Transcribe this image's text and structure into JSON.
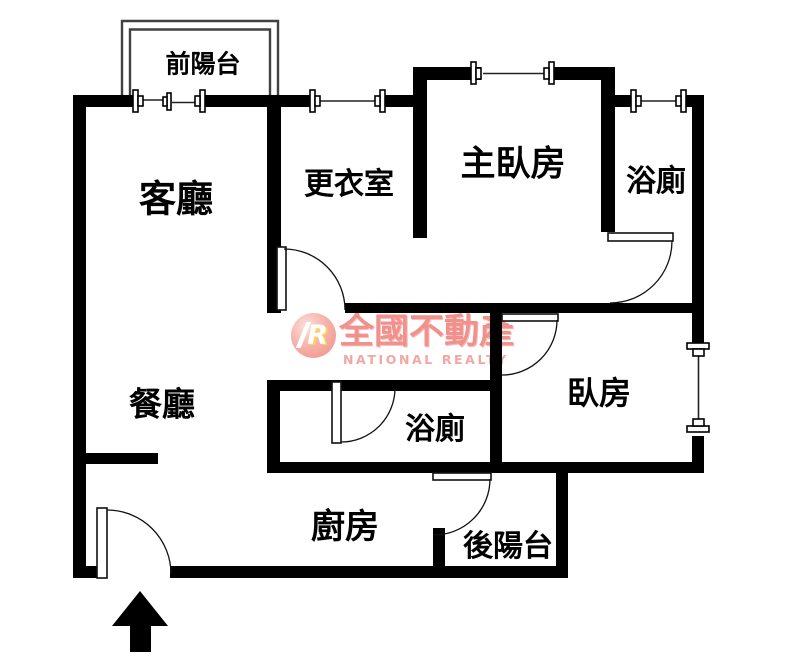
{
  "floorplan": {
    "rooms": [
      {
        "id": "front-balcony",
        "label": "前陽台"
      },
      {
        "id": "living-room",
        "label": "客廳"
      },
      {
        "id": "walk-in-closet",
        "label": "更衣室"
      },
      {
        "id": "master-bedroom",
        "label": "主臥房"
      },
      {
        "id": "bathroom-top",
        "label": "浴廁"
      },
      {
        "id": "dining-room",
        "label": "餐廳"
      },
      {
        "id": "bathroom-middle",
        "label": "浴廁"
      },
      {
        "id": "bedroom",
        "label": "臥房"
      },
      {
        "id": "kitchen",
        "label": "廚房"
      },
      {
        "id": "rear-balcony",
        "label": "後陽台"
      }
    ],
    "watermark": {
      "logo_letter": "R",
      "brand_cn": "全國不動產",
      "brand_en": "NATIONAL REALTY",
      "brand_color": "#f0918d"
    },
    "colors": {
      "wall": "#000000",
      "thin_line": "#222222",
      "background": "#ffffff"
    }
  }
}
